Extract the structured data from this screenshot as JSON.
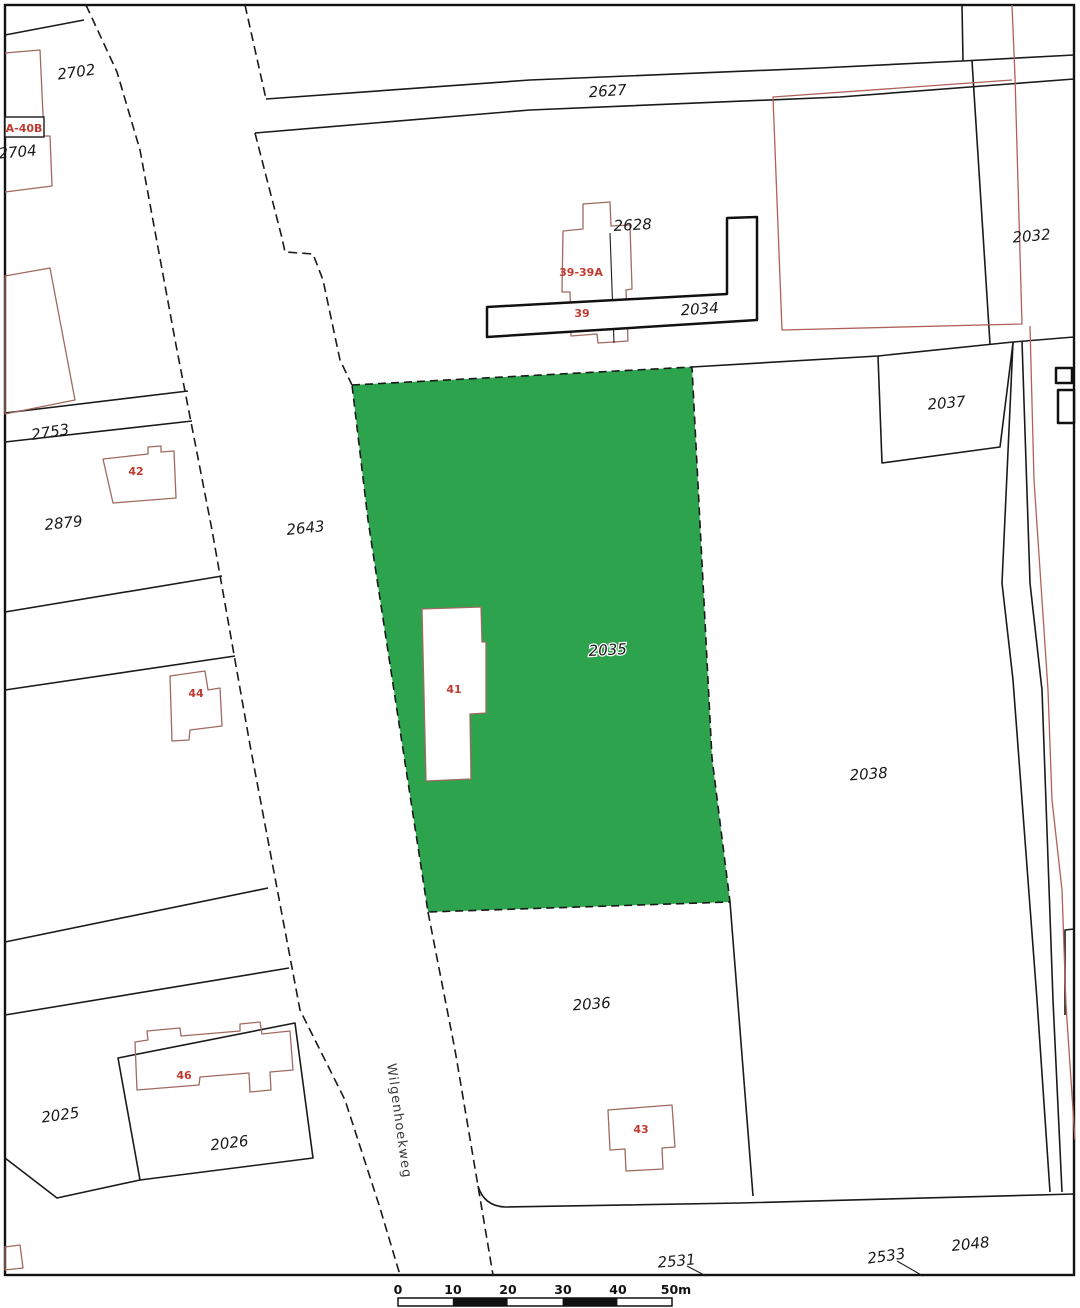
{
  "selected_parcel": "2035",
  "colors": {
    "highlight": "#2ca34c",
    "boundary": "#1a1a1a",
    "thick": "#111111",
    "redline": "#b0605a",
    "building_outline": "#a06a60",
    "house_label": "#c03a30",
    "label": "#1a1a1a"
  },
  "parcels": [
    {
      "id": "2702",
      "label": "2702"
    },
    {
      "id": "2704",
      "label": "2704"
    },
    {
      "id": "2627",
      "label": "2627"
    },
    {
      "id": "2628",
      "label": "2628"
    },
    {
      "id": "2034",
      "label": "2034"
    },
    {
      "id": "2032",
      "label": "2032"
    },
    {
      "id": "2753",
      "label": "2753"
    },
    {
      "id": "2879",
      "label": "2879"
    },
    {
      "id": "2643",
      "label": "2643"
    },
    {
      "id": "2037",
      "label": "2037"
    },
    {
      "id": "2035",
      "label": "2035"
    },
    {
      "id": "2038",
      "label": "2038"
    },
    {
      "id": "2036",
      "label": "2036"
    },
    {
      "id": "2025",
      "label": "2025"
    },
    {
      "id": "2026",
      "label": "2026"
    },
    {
      "id": "2531",
      "label": "2531"
    },
    {
      "id": "2533",
      "label": "2533"
    },
    {
      "id": "2048",
      "label": "2048"
    }
  ],
  "houses": [
    {
      "id": "A-40B",
      "label": "A-40B"
    },
    {
      "id": "42",
      "label": "42"
    },
    {
      "id": "44",
      "label": "44"
    },
    {
      "id": "46",
      "label": "46"
    },
    {
      "id": "41",
      "label": "41"
    },
    {
      "id": "43",
      "label": "43"
    },
    {
      "id": "39-39A",
      "label": "39-39A"
    },
    {
      "id": "39",
      "label": "39"
    }
  ],
  "street": {
    "name": "Wilgenhoekweg"
  },
  "scalebar": {
    "ticks": [
      "0",
      "10",
      "20",
      "30",
      "40",
      "50m"
    ]
  }
}
